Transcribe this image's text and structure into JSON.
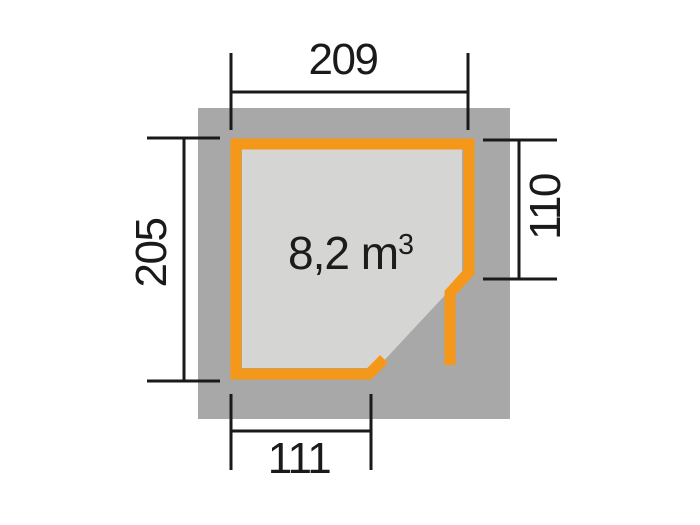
{
  "diagram": {
    "type": "floor-plan",
    "volume_label": {
      "value": "8,2 m",
      "superscript": "3"
    },
    "dimensions": {
      "width_top": "209",
      "height_left": "205",
      "height_right": "110",
      "width_bottom": "111"
    },
    "colors": {
      "wall": "#F59719",
      "base": "#A8A8A8",
      "floor": "#D5D5D3",
      "dimension_line": "#1A1A1A",
      "background": "#FFFFFF"
    }
  }
}
